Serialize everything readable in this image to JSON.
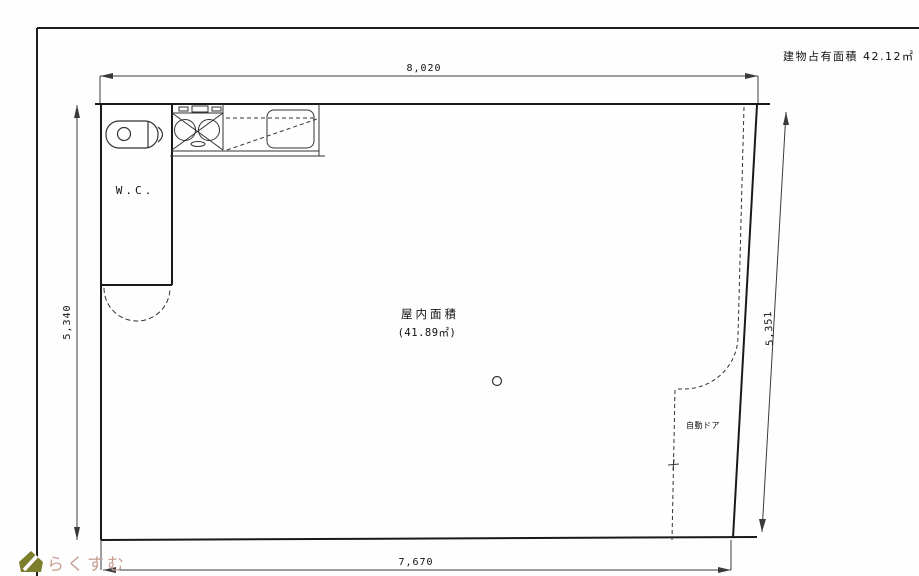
{
  "plan": {
    "building_area_note": "建物占有面積 42.12㎡",
    "room": {
      "area_label": "屋内面積",
      "area_value": "(41.89㎡)"
    },
    "wc_label": "W.C.",
    "auto_door_label": "自動ドア",
    "dimensions": {
      "top": "8,020",
      "bottom": "7,670",
      "left": "5,340",
      "right": "5,351"
    }
  },
  "watermark": {
    "text": "らくすむ",
    "icon": "house-icon",
    "icon_color": "#7d7e2c",
    "text_color": "#c7a092"
  },
  "colors": {
    "wall_line": "#1a1a1a",
    "dimension_line": "#3a3a3a",
    "background": "#fefefe"
  }
}
